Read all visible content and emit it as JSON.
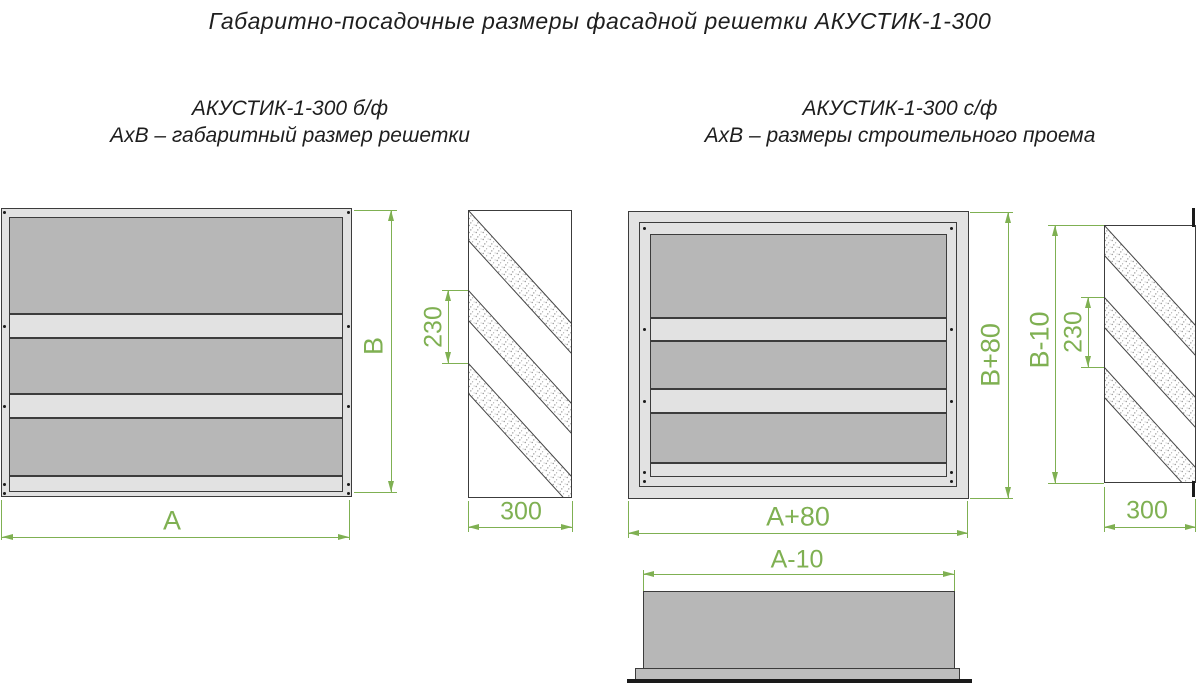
{
  "title": "Габаритно-посадочные размеры фасадной решетки АКУСТИК-1-300",
  "variants": {
    "left": {
      "name": "АКУСТИК-1-300 б/ф",
      "description": "АхВ – габаритный размер решетки"
    },
    "right": {
      "name": "АКУСТИК-1-300 с/ф",
      "description": "АхВ – размеры строительного проема"
    }
  },
  "dimensions": {
    "left_front": {
      "width": "А",
      "height": "В"
    },
    "left_side": {
      "lamella_pitch": "230",
      "depth": "300"
    },
    "right_front": {
      "width": "А+80",
      "height": "В+80"
    },
    "right_side": {
      "height": "В-10",
      "lamella_pitch": "230",
      "depth": "300"
    },
    "bottom_view": {
      "width": "А-10"
    }
  },
  "colors": {
    "dimension_green": "#7fb052",
    "panel_dark": "#b7b7b7",
    "panel_light": "#e2e2e2",
    "outline_dark": "#3c3c3c"
  }
}
